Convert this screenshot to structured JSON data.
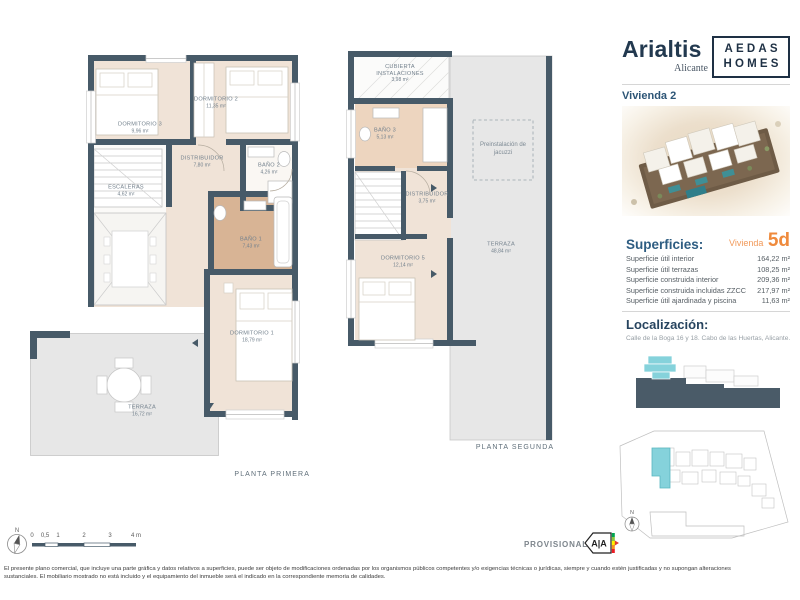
{
  "header": {
    "project": "Arialtis",
    "city": "Alicante",
    "brand_line1": "AEDAS",
    "brand_line2": "HOMES",
    "unit_title": "Vivienda 2"
  },
  "superficies": {
    "title": "Superficies:",
    "unit_prefix": "Vivienda",
    "unit_code": "5d",
    "rows": [
      {
        "label": "Superficie útil interior",
        "value": "164,22 m²"
      },
      {
        "label": "Superficie útil terrazas",
        "value": "108,25 m²"
      },
      {
        "label": "Superficie construida interior",
        "value": "209,36 m²"
      },
      {
        "label": "Superficie construida incluidas ZZCC",
        "value": "217,97 m²"
      },
      {
        "label": "Superficie útil ajardinada y piscina",
        "value": "11,63 m²"
      }
    ]
  },
  "localizacion": {
    "title": "Localización:",
    "address": "Calle de la Boga 16 y 18. Cabo de las Huertas, Alicante."
  },
  "plans": {
    "first": {
      "caption": "PLANTA PRIMERA",
      "rooms": {
        "dormitorio3": {
          "name": "DORMITORIO 3",
          "area": "9,96 m²"
        },
        "dormitorio2": {
          "name": "DORMITORIO 2",
          "area": "11,35 m²"
        },
        "distribuidor": {
          "name": "DISTRIBUIDOR",
          "area": "7,80 m²"
        },
        "bano2": {
          "name": "BAÑO 2",
          "area": "4,26 m²"
        },
        "escaleras": {
          "name": "ESCALERAS",
          "area": "4,62 m²"
        },
        "bano1": {
          "name": "BAÑO 1",
          "area": "7,43 m²"
        },
        "dormitorio1": {
          "name": "DORMITORIO 1",
          "area": "18,79 m²"
        },
        "terraza": {
          "name": "TERRAZA",
          "area": "16,72 m²"
        }
      }
    },
    "second": {
      "caption": "PLANTA SEGUNDA",
      "rooms": {
        "cubierta": {
          "name": "CUBIERTA INSTALACIONES",
          "area": "3,98 m²"
        },
        "bano3": {
          "name": "BAÑO 3",
          "area": "5,13 m²"
        },
        "distribuidor": {
          "name": "DISTRIBUIDOR",
          "area": "3,75 m²"
        },
        "dormitorio5": {
          "name": "DORMITORIO 5",
          "area": "12,14 m²"
        },
        "terraza": {
          "name": "TERRAZA",
          "area": "48,84 m²"
        },
        "jacuzzi": {
          "label": "Preinstalación de jacuzzi"
        }
      }
    }
  },
  "footer": {
    "north": "N",
    "scale_labels": [
      "0",
      "0,5",
      "1",
      "2",
      "3",
      "4 m"
    ],
    "provisional": "PROVISIONAL",
    "energy_label": "A|A",
    "disclaimer": "El presente plano comercial, que incluye una parte gráfica y datos relativos a superficies, puede ser objeto de modificaciones ordenadas por los organismos públicos competentes y/o exigencias técnicas o jurídicas, siempre y cuando estén justificadas y no supongan alteraciones sustanciales. El mobiliario mostrado no está incluido y el equipamiento del inmueble será el indicado en la correspondiente memoria de calidades."
  },
  "colors": {
    "wall": "#475a68",
    "interior_floor": "#f0e3d7",
    "bath_tan": "#d8b495",
    "terrace_gray": "#e7e7e7",
    "highlight_cyan": "#85d2db",
    "accent_orange": "#ef8a3c",
    "navy": "#22394f",
    "title_blue": "#2e5d82"
  }
}
